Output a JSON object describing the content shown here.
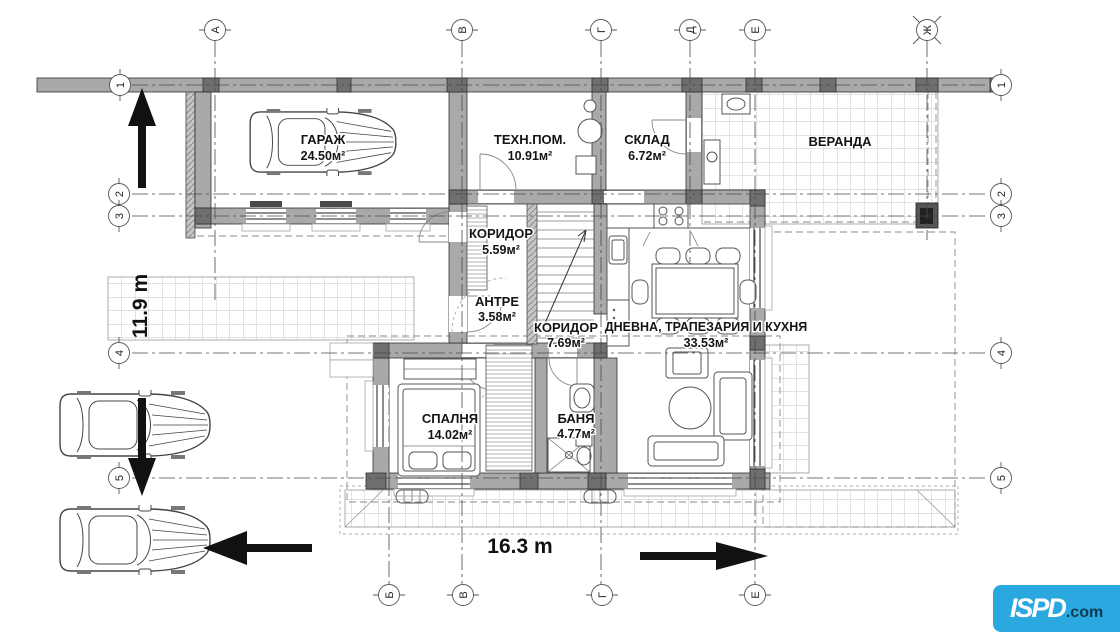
{
  "rooms": [
    {
      "name": "ГАРАЖ",
      "area": "24.50м²"
    },
    {
      "name": "ТЕХН.ПОМ.",
      "area": "10.91м²"
    },
    {
      "name": "СКЛАД",
      "area": "6.72м²"
    },
    {
      "name": "ВЕРАНДА",
      "area": ""
    },
    {
      "name": "КОРИДОР",
      "area": "5.59м²"
    },
    {
      "name": "АНТРЕ",
      "area": "3.58м²"
    },
    {
      "name": "КОРИДОР",
      "area": "7.69м²"
    },
    {
      "name": "ДНЕВНА, ТРАПЕЗАРИЯ И КУХНЯ",
      "area": "33.53м²"
    },
    {
      "name": "СПАЛНЯ",
      "area": "14.02м²"
    },
    {
      "name": "БАНЯ",
      "area": "4.77м²"
    }
  ],
  "dimensions": {
    "width": "16.3 m",
    "depth": "11.9 m"
  },
  "axes": {
    "top": [
      "А",
      "В",
      "Г",
      "Д",
      "Е",
      "Ж"
    ],
    "bottom": [
      "Б",
      "В",
      "Г",
      "Е"
    ],
    "left": [
      "1",
      "2",
      "3",
      "4",
      "5"
    ],
    "right": [
      "1",
      "2",
      "3",
      "4",
      "5"
    ]
  },
  "icons": {
    "arrows": [
      "up-arrow",
      "down-arrow",
      "left-arrow",
      "right-arrow"
    ],
    "stairs": "stairs-up-arrow"
  },
  "colors": {
    "wall": "#a9a9a9",
    "wall_dark": "#6f6f6f",
    "line": "#2f2f2f",
    "logo_bg": "#2AA9E0",
    "logo_text": "#ffffff",
    "logo_suffix": "#0e3a52"
  },
  "logo": {
    "brand": "ISPD",
    "suffix": ".com"
  }
}
